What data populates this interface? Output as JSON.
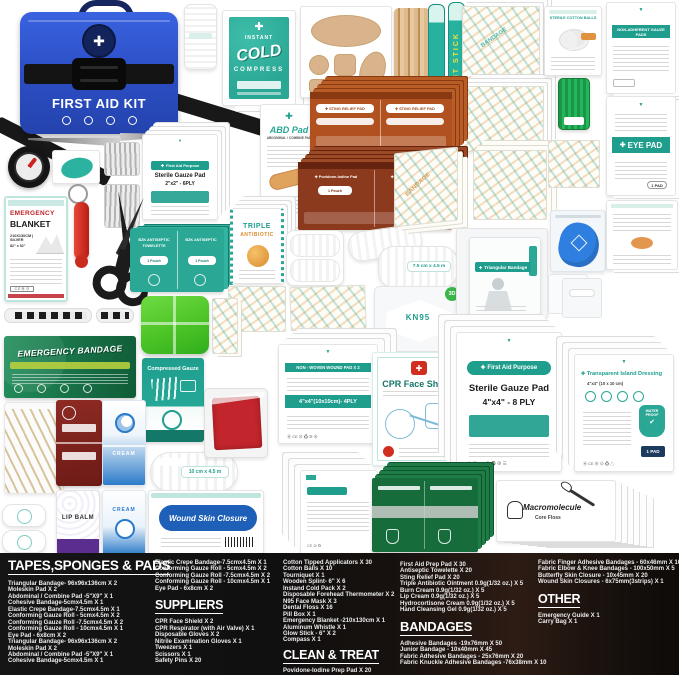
{
  "colors": {
    "teal": "#1f9e8e",
    "orange_sting": "#b0511f",
    "rust": "#8c3a1e",
    "green_bandage": "#1e8150",
    "green_prep": "#176c3c",
    "bag_blue": "#2c4fc6",
    "red": "#c2252b",
    "pill_green": "#4cc426",
    "floss_green": "#1faa52",
    "closure_blue": "#1e5fb8"
  },
  "icons": {
    "cross": "✚",
    "arrow_down": "▼",
    "check": "✔",
    "dot": "●"
  },
  "collage": {
    "bag_label": "FIRST AID KIT",
    "cold_compress": {
      "l1": "INSTANT",
      "l2": "COLD",
      "l3": "COMPRESS"
    },
    "light_stick": "LIGHT STICK",
    "cotton_balls": "STERILE COTTON BALLS",
    "non_adherent": "NON-ADHERENT GAUZE PADS",
    "eye_pad": "EYE PAD",
    "gauze_small": {
      "brand": "First Aid Purpose",
      "name": "Sterile Gauze Pad",
      "size": "2\"x2\" - 6PLY"
    },
    "abd": {
      "name": "ABD Pad",
      "sub": "ABDOMINAL / COMBINE PAD"
    },
    "sting": "STING RELIEF PAD",
    "povidone": {
      "name": "Povidone-Iodine Pad",
      "pouch": "1 Pouch"
    },
    "towelette": {
      "l1": "BZK ANTISEPTIC",
      "l2": "TOWELETTE",
      "pouch": "1 Pouch"
    },
    "triple": {
      "l1": "TRIPLE",
      "l2": "ANTIBIOTIC"
    },
    "blanket": {
      "l1": "EMERGENCY",
      "l2": "BLANKET",
      "l3": "210X130CM | SILVER",
      "l4": "82\" x 52\""
    },
    "em_bandage": "EMERGENCY BANDAGE",
    "comp_gauze": "Compressed Gauze",
    "roll_75": "7.5 cm x 4.5 m",
    "roll_10": "10 cm x 4.5 m",
    "kn95": {
      "name": "KN95",
      "badge": "3D"
    },
    "wound_pad": {
      "l1": "NON - WOVEN WOUND PAD X 2",
      "l2": "4\"x4\"(10x10cm)- 4PLY"
    },
    "cpr": "CPR Face Shield",
    "triangular": "Triangular Bandage",
    "gauze_large": {
      "brand": "First Aid Purpose",
      "name": "Sterile Gauze Pad",
      "size": "4\"x4\" - 8 PLY"
    },
    "island": {
      "name": "Transparent Island Dressing",
      "size": "4\"x4\" (10 x 10 cm)",
      "badge1": "WATER",
      "badge2": "PROOF",
      "pads": "1 PAD"
    },
    "closure": "Wound Skin Closure",
    "lip_balm": "LIP BALM",
    "cream": "CREAM",
    "floss": {
      "brand": "Macromolecule",
      "name": "Core Floss"
    },
    "bandage_word": "BANDAGE"
  },
  "legend": {
    "col1": {
      "heading": "TAPES,SPONGES & PADS",
      "items": [
        "Triangular Bandage- 96x96x136cm X 2",
        "Moleskin Pad X 2",
        "Abdominal / Combine Pad -5\"X9\" X 1",
        "Cohesive Bandage-5cmx4.5m X 1",
        "Elastic Crepe Bandage-7.5cmx4.5m X 1",
        "Conforming Gauze Roll - 5cmx4.5m X 2",
        "Conforming Gauze Roll -7.5cmx4.5m X 2",
        "Conforming Gauze Roll - 10cmx4.5m X 1",
        "Eye Pad - 6x8cm X 2",
        "Triangular Bandage- 96x96x136cm X 2",
        "Moleskin Pad X 2",
        "Abdominal / Combine Pad -5\"X9\" X 1",
        "Cohesive Bandage-5cmx4.5m X 1"
      ]
    },
    "col2": {
      "pre_items": [
        "Elastic Crepe Bandage-7.5cmx4.5m X 1",
        "Conforming Gauze Roll - 5cmx4.5m X 2",
        "Conforming Gauze Roll -7.5cmx4.5m X 2",
        "Conforming Gauze Roll - 10cmx4.5m X 1",
        "Eye Pad - 6x8cm X 2"
      ],
      "heading": "SUPPLIERS",
      "items": [
        "CPR Face Shield X 2",
        "CPR Respirator (with Air Valve) X 1",
        "Disposable Gloves X 2",
        "Nitrile Examination Gloves X 1",
        "Tweezers X 1",
        "Scissors  X 1",
        "Safety Pins X 20"
      ]
    },
    "col3": {
      "pre_items": [
        "Cotton Tipped Applicators X 30",
        "Cotton Balls X 10",
        "Tourniquet X 1",
        "Wooden Splint- 6\" X 6",
        "Instand Cold Pack X 2",
        "Disposable Forehead Thermometer X 2",
        "N95 Face Mask X 3",
        "Dental Floss X 16",
        "Pill Box X 1",
        "Emergency Blanket -210x130cm X 1",
        "Aluminum  Whistle X 1",
        "Glow Stick - 6\" X 2",
        "Compass X 1"
      ],
      "heading": "CLEAN & TREAT",
      "items": [
        "Povidone-Iodine Prep Pad X 20"
      ]
    },
    "col4": {
      "pre_items": [
        "First Aid Prep Pad X 30",
        "Antiseptic Towelette X 20",
        "Sting Relief Pad X 20",
        "Triple Antibiotic Ointment  0.9g(1/32 oz.) X 5",
        "Burn Cream  0.9g(1/32 oz.) X 5",
        "Lip Cream 0.9g(1/32 oz.) X 5",
        "Hydrocortisone Cream 0.9g(1/32 oz.) X 5",
        "Hand Cleansing Gel 0.9g(1/32 oz.) X 5"
      ],
      "heading": "BANDAGES",
      "items": [
        "Adhesive Bandages -19x76mm X 50",
        "Junior Bandage - 10x40mm X 45",
        "Fabric Adhesive Bandages - 25x76mm X 20",
        "Fabric Knuckle Adhesive Bandages -76x38mm X 10"
      ]
    },
    "col5": {
      "pre_items": [
        "Fabric Finger Adhesive Bandages - 60x46mm X 10",
        "Fabric Elbow & Knee Bandages - 100x50mm X 5",
        "Butterfly Skin Closure - 10x45mm X 20",
        "Wound Skin Closures - 6x75mm(3strips) X 1"
      ],
      "heading": "OTHER",
      "items": [
        "Emergency Guide X 1",
        "Carry Bag X 1"
      ]
    }
  }
}
